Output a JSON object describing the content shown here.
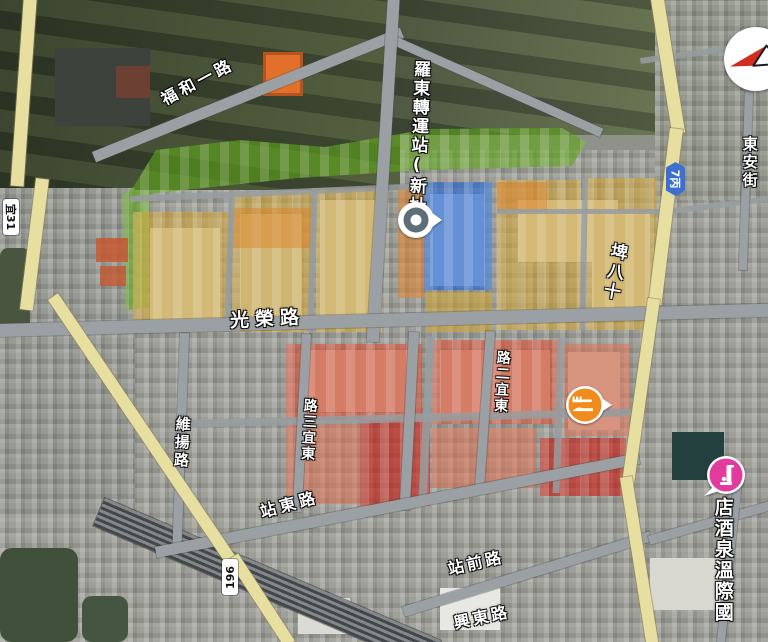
{
  "map": {
    "station_label": "羅東轉運站(新址)",
    "shields": [
      {
        "id": "yi-31",
        "label": "宜31",
        "style": "county-white"
      },
      {
        "id": "7-bing",
        "label": "7丙",
        "style": "township-blue",
        "color": "#3d6fd1"
      },
      {
        "id": "196",
        "label": "196",
        "style": "county-white"
      }
    ],
    "streets": [
      {
        "id": "fuhe-1-rd",
        "text": "福和一路"
      },
      {
        "id": "dongan-st",
        "text": "東安街"
      },
      {
        "id": "shiba-pi",
        "text": "十八埤"
      },
      {
        "id": "guangrong-rd",
        "text": "光榮路"
      },
      {
        "id": "weiyang-rd",
        "text": "維揚路"
      },
      {
        "id": "dongyi-3-rd",
        "text": "東宜三路"
      },
      {
        "id": "dongyi-2-rd",
        "text": "東宜二路"
      },
      {
        "id": "zhandong-rd",
        "text": "站東路"
      },
      {
        "id": "zhanqian-rd",
        "text": "站前路"
      },
      {
        "id": "xingdong-rd",
        "text": "興東路"
      },
      {
        "id": "hotel-name",
        "text": "國際溫泉酒店"
      }
    ],
    "pois": [
      {
        "id": "transit-station",
        "icon": "transit-location-marker",
        "color": "#5d6e78"
      },
      {
        "id": "restaurant",
        "icon": "restaurant-fork-knife-icon",
        "color": "#ef8c1c"
      },
      {
        "id": "hotel",
        "icon": "hotel-bed-icon",
        "color": "#e23a9d"
      }
    ],
    "compass": {
      "icon": "compass-needle-icon",
      "needle_color": "#d22c20"
    },
    "zone_colors": {
      "green": "rgba(96,165,28,0.62)",
      "yellow": "rgba(208,162,44,0.55)",
      "orange": "rgba(224,128,40,0.50)",
      "blue": "rgba(36,102,212,0.62)",
      "red": "rgba(222,70,40,0.55)",
      "deep_red": "rgba(198,28,16,0.62)",
      "salmon": "rgba(232,110,78,0.50)"
    },
    "road_colors": {
      "major": "#9aa0a4",
      "route_yellow": "#e6dfa0"
    }
  }
}
